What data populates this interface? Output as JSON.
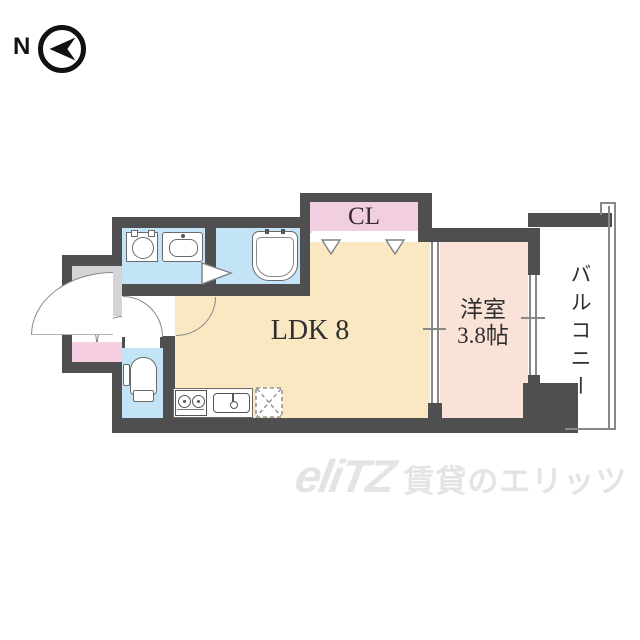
{
  "compass": {
    "label": "N"
  },
  "rooms": {
    "ldk": {
      "label": "LDK 8"
    },
    "closet": {
      "label": "CL"
    },
    "western": {
      "label": "洋室",
      "size": "3.8帖"
    },
    "balcony": {
      "label": "バルコニー"
    },
    "entrance": {
      "label": "玄"
    }
  },
  "fixtures": [
    "washing-machine-pan",
    "vanity-sink",
    "bathtub",
    "bath-door-arrow",
    "toilet",
    "gas-stove",
    "kitchen-sink",
    "refrigerator-space",
    "closet-folding-door-arrows",
    "sliding-door",
    "window"
  ],
  "watermark": {
    "logo": "eliTZ",
    "text": "賃貸のエリッツ"
  },
  "colors": {
    "wall": "#4F4F4F",
    "room_ldk": "#F9E8C1",
    "room_western": "#F9E3D8",
    "room_closet": "#F1CEE0",
    "room_wet": "#C3E4F6",
    "entrance_floor": "#D4D4D6",
    "entrance_accent": "#F6D0E2",
    "line": "#888888",
    "label": "#2F2F2F",
    "watermark": "#E4E4E4",
    "compass": "#111111"
  }
}
